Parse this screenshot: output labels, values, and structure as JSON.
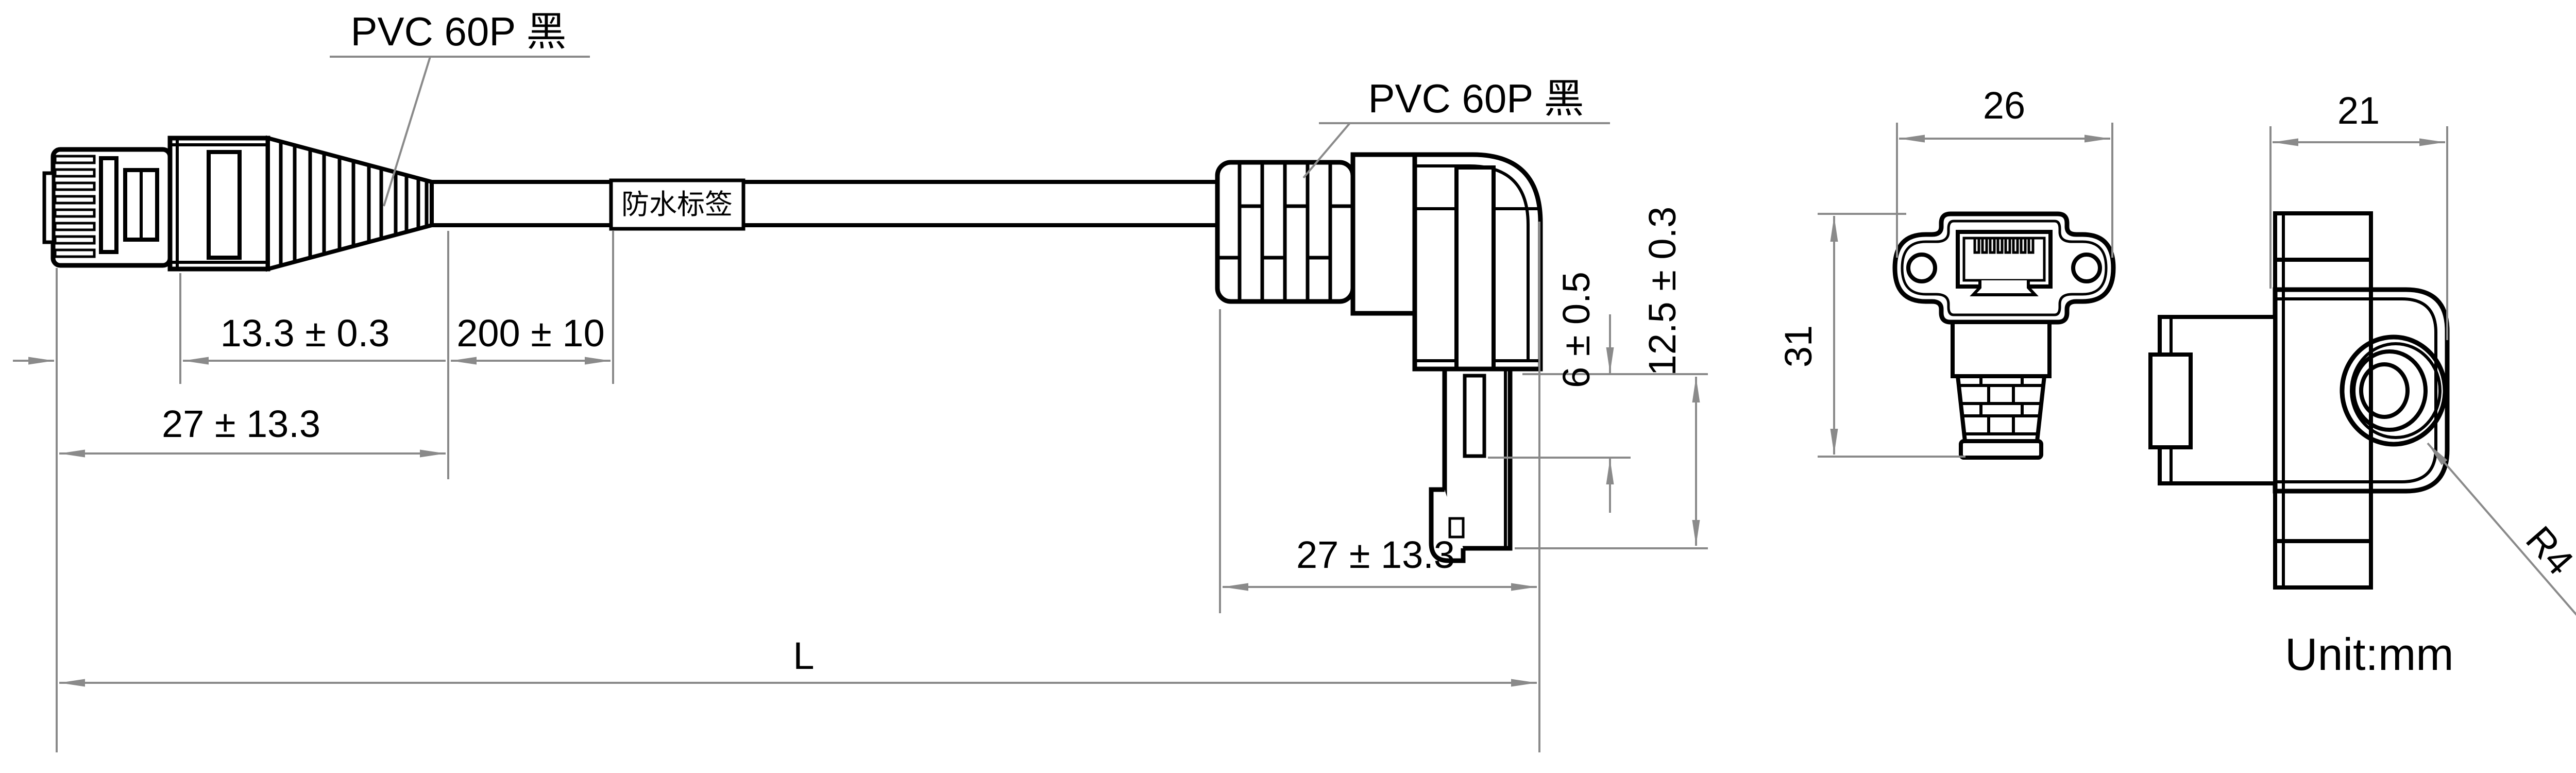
{
  "annotations": {
    "left_material": "PVC 60P 黑",
    "right_material": "PVC 60P 黑",
    "cable_label": "防水标签",
    "unit_note": "Unit:mm"
  },
  "dimensions": {
    "plug_body_length": "13.3 ± 0.3",
    "label_distance": "200 ± 10",
    "left_connector_length": "27 ± 13.3",
    "right_connector_length": "27 ± 13.3",
    "neck_height": "6 ± 0.5",
    "plug_height": "12.5 ± 0.3",
    "overall_length": "L",
    "flange_width": "26",
    "flange_height": "31",
    "side_width": "21",
    "corner_radius": "R4"
  },
  "colors": {
    "line": "#000000",
    "dimension": "#8a8a8a",
    "background": "#ffffff"
  }
}
